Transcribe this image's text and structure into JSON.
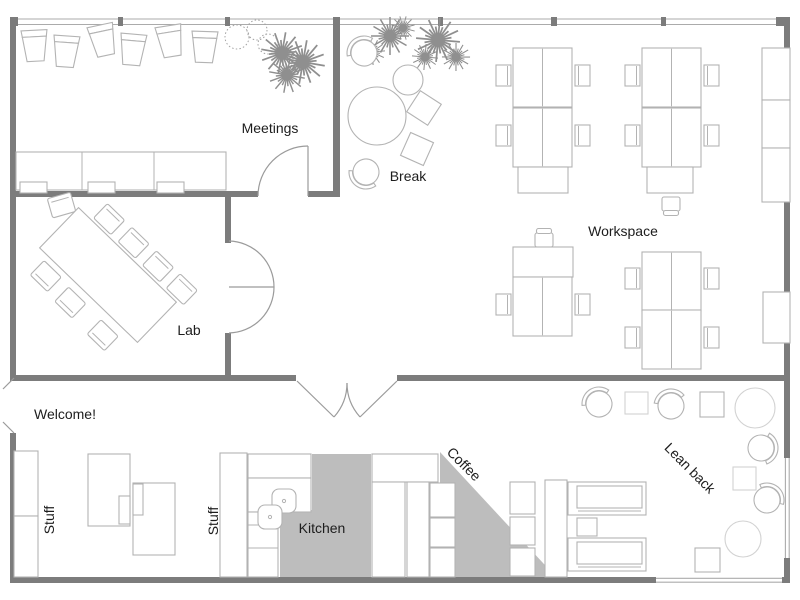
{
  "floorplan": {
    "title": "Office floor plan",
    "labels": {
      "meetings": "Meetings",
      "break": "Break",
      "workspace": "Workspace",
      "lab": "Lab",
      "welcome": "Welcome!",
      "stuff_left": "Stuff",
      "stuff_middle": "Stuff",
      "kitchen": "Kitchen",
      "coffee": "Coffee",
      "lean_back": "Lean back"
    },
    "colors": {
      "wall": "#7c7c7c",
      "window": "#ababab",
      "furniture_outline": "#b3b3b3",
      "floor_area_fill": "#bdbdbd",
      "label_text": "#1d1d1d"
    }
  }
}
